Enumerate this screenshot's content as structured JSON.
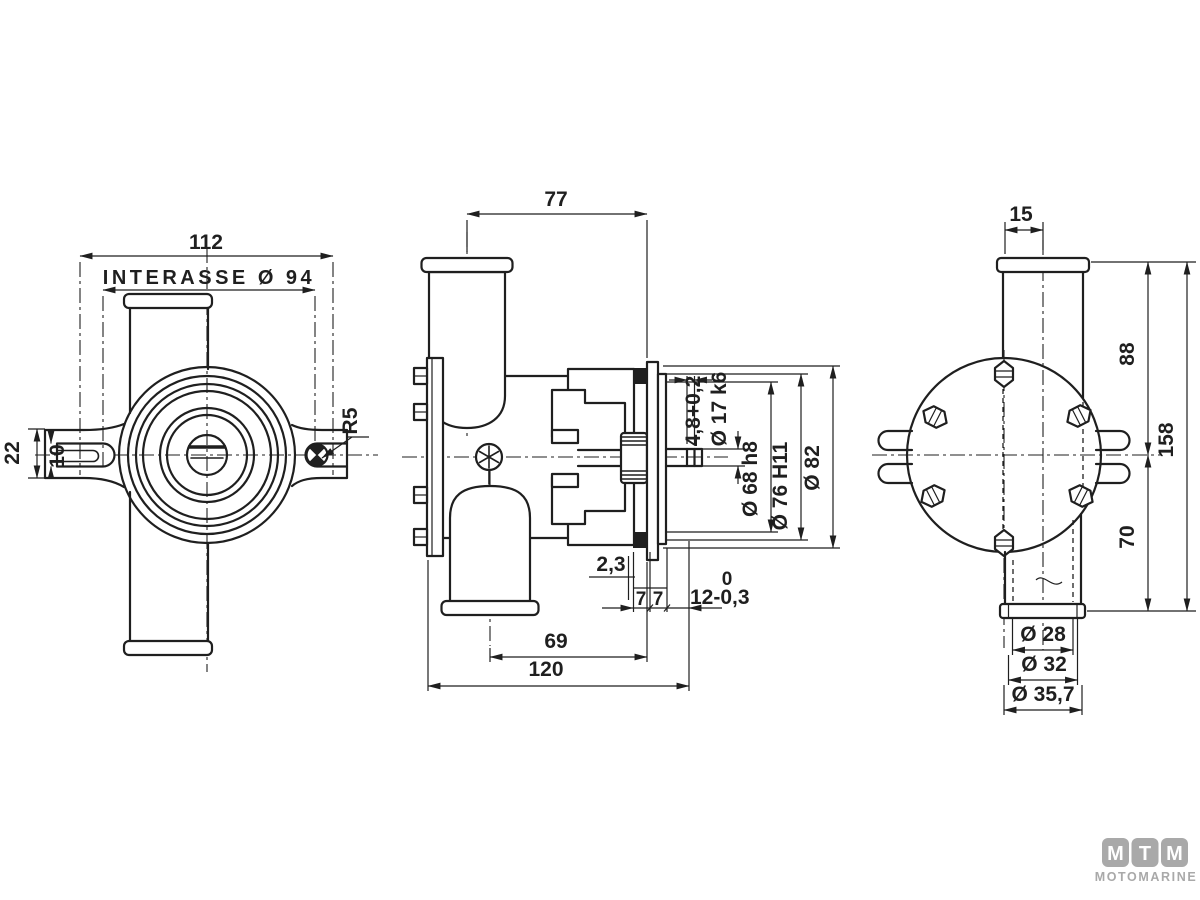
{
  "colors": {
    "line": "#1f1f1f",
    "logo_gray": "#a9a9a9"
  },
  "front_view": {
    "dim_overall_width": "112",
    "dim_bolt_spacing": "INTERASSE Ø 94",
    "dim_ear_height": "22",
    "dim_slot_width": "10",
    "dim_fillet_radius": "R5"
  },
  "side_view": {
    "dim_port_to_face": "77",
    "dim_groove_width": "4,8+0,2",
    "dim_shaft_dia": "Ø 17 k6",
    "dim_spigot_dia": "Ø 68 h8",
    "dim_pilot_dia": "Ø 76 H11",
    "dim_flange_dia": "Ø 82",
    "dim_clearance": "2,3",
    "dim_flange_thk_a": "7",
    "dim_flange_thk_b": "7",
    "dim_shaft_tol_upper": "0",
    "dim_shaft_proj": "12-0,3",
    "dim_port_center": "69",
    "dim_overall_length": "120"
  },
  "rear_view": {
    "dim_port_offset": "15",
    "dim_upper_height": "88",
    "dim_overall_height": "158",
    "dim_lower_height": "70",
    "dim_hose_bore": "Ø 28",
    "dim_hose_mid": "Ø 32",
    "dim_hose_od": "Ø 35,7"
  },
  "logo": {
    "letter_1": "M",
    "letter_2": "T",
    "letter_3": "M",
    "subtitle": "MOTOMARINE"
  }
}
